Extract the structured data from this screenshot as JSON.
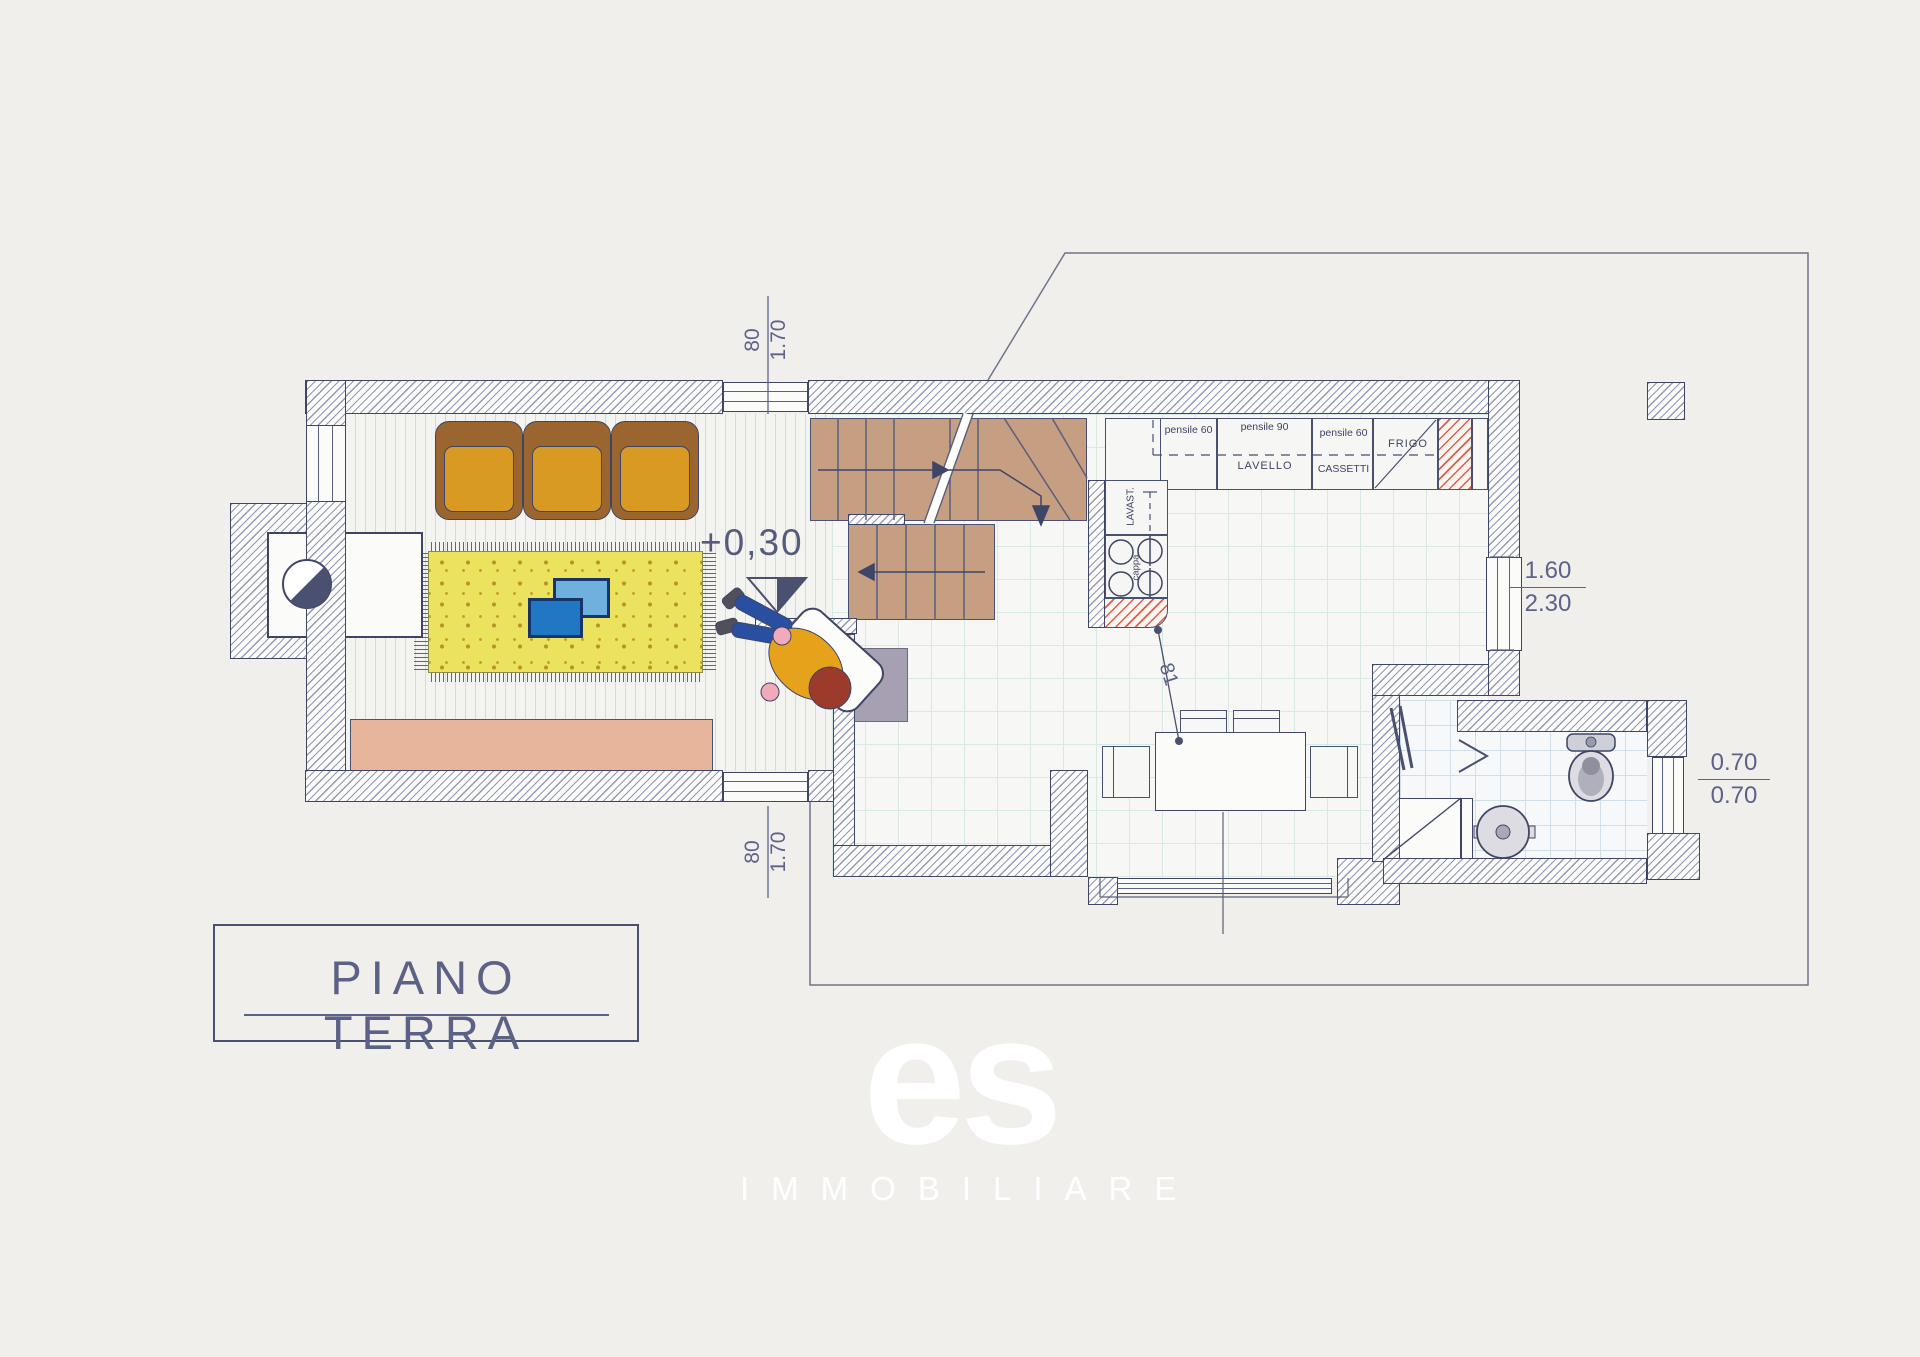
{
  "title": {
    "label": "PIANO TERRA"
  },
  "watermark": {
    "mark": "es",
    "sub": "IMMOBILIARE"
  },
  "annotations": {
    "floor_level": "+0,30",
    "window_top_dim": {
      "over": "80",
      "under": "1.70"
    },
    "window_bottom_dim": {
      "over": "80",
      "under": "1.70"
    },
    "window_right_dim": {
      "over": "1.60",
      "under": "2.30"
    },
    "bath_window_dim": {
      "over": "0.70",
      "under": "0.70"
    },
    "column_to_table": "81"
  },
  "kitchen": {
    "wall_unit_left": "pensile 60",
    "wall_unit_center": "pensile 90",
    "wall_unit_right": "pensile 60",
    "sink": "LAVELLO",
    "drawers": "CASSETTI",
    "fridge": "FRIGO",
    "dishwasher": "LAVAST.",
    "hood": "cappa"
  },
  "colors": {
    "wall_line": "#3f4566",
    "stairs": "#c69e82",
    "rug": "#ebe25e",
    "sofa_frame": "#9b652f",
    "sofa_cushion": "#d89a22",
    "accent_red": "#d8604a"
  }
}
